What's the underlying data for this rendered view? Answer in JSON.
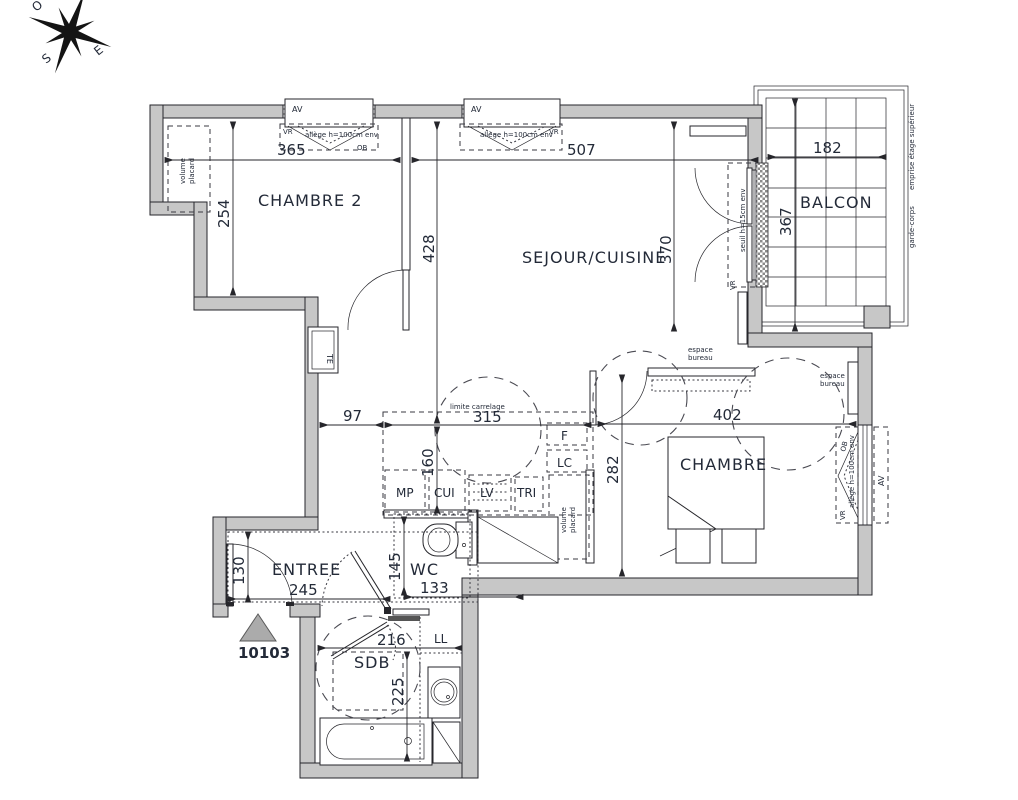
{
  "compass": {
    "o": "O",
    "e": "E",
    "s": "S"
  },
  "rooms": {
    "chambre2": "CHAMBRE 2",
    "sejour": "SEJOUR/CUISINE",
    "balcon": "BALCON",
    "chambre": "CHAMBRE",
    "entree": "ENTREE",
    "wc": "WC",
    "sdb": "SDB"
  },
  "dims": {
    "d365": "365",
    "d507": "507",
    "d182": "182",
    "d254": "254",
    "d428": "428",
    "d370": "370",
    "d367": "367",
    "d97": "97",
    "d315": "315",
    "d160": "160",
    "d402": "402",
    "d282": "282",
    "d130": "130",
    "d245": "245",
    "d145": "145",
    "d133": "133",
    "d216": "216",
    "d225": "225"
  },
  "fixtures": {
    "te": "TE",
    "f": "F",
    "lc": "LC",
    "mp": "MP",
    "cui": "CUI",
    "lv": "LV",
    "tri": "TRI",
    "ll": "LL"
  },
  "notes": {
    "volume": "volume",
    "placard": "placard",
    "espace": "espace",
    "bureau": "bureau",
    "limite_carrelage": "limite carrelage",
    "av": "AV",
    "vr": "VR",
    "ob": "OB",
    "allege": "allège h=100cm env",
    "seuil": "seuil h=15cm env",
    "emprise": "emprise étage supérieur",
    "garde_corps": "garde-corps"
  },
  "unit": {
    "number": "10103"
  },
  "colors": {
    "wall_fill": "#c7c7c7",
    "line": "#26262b",
    "text": "#232a38"
  }
}
